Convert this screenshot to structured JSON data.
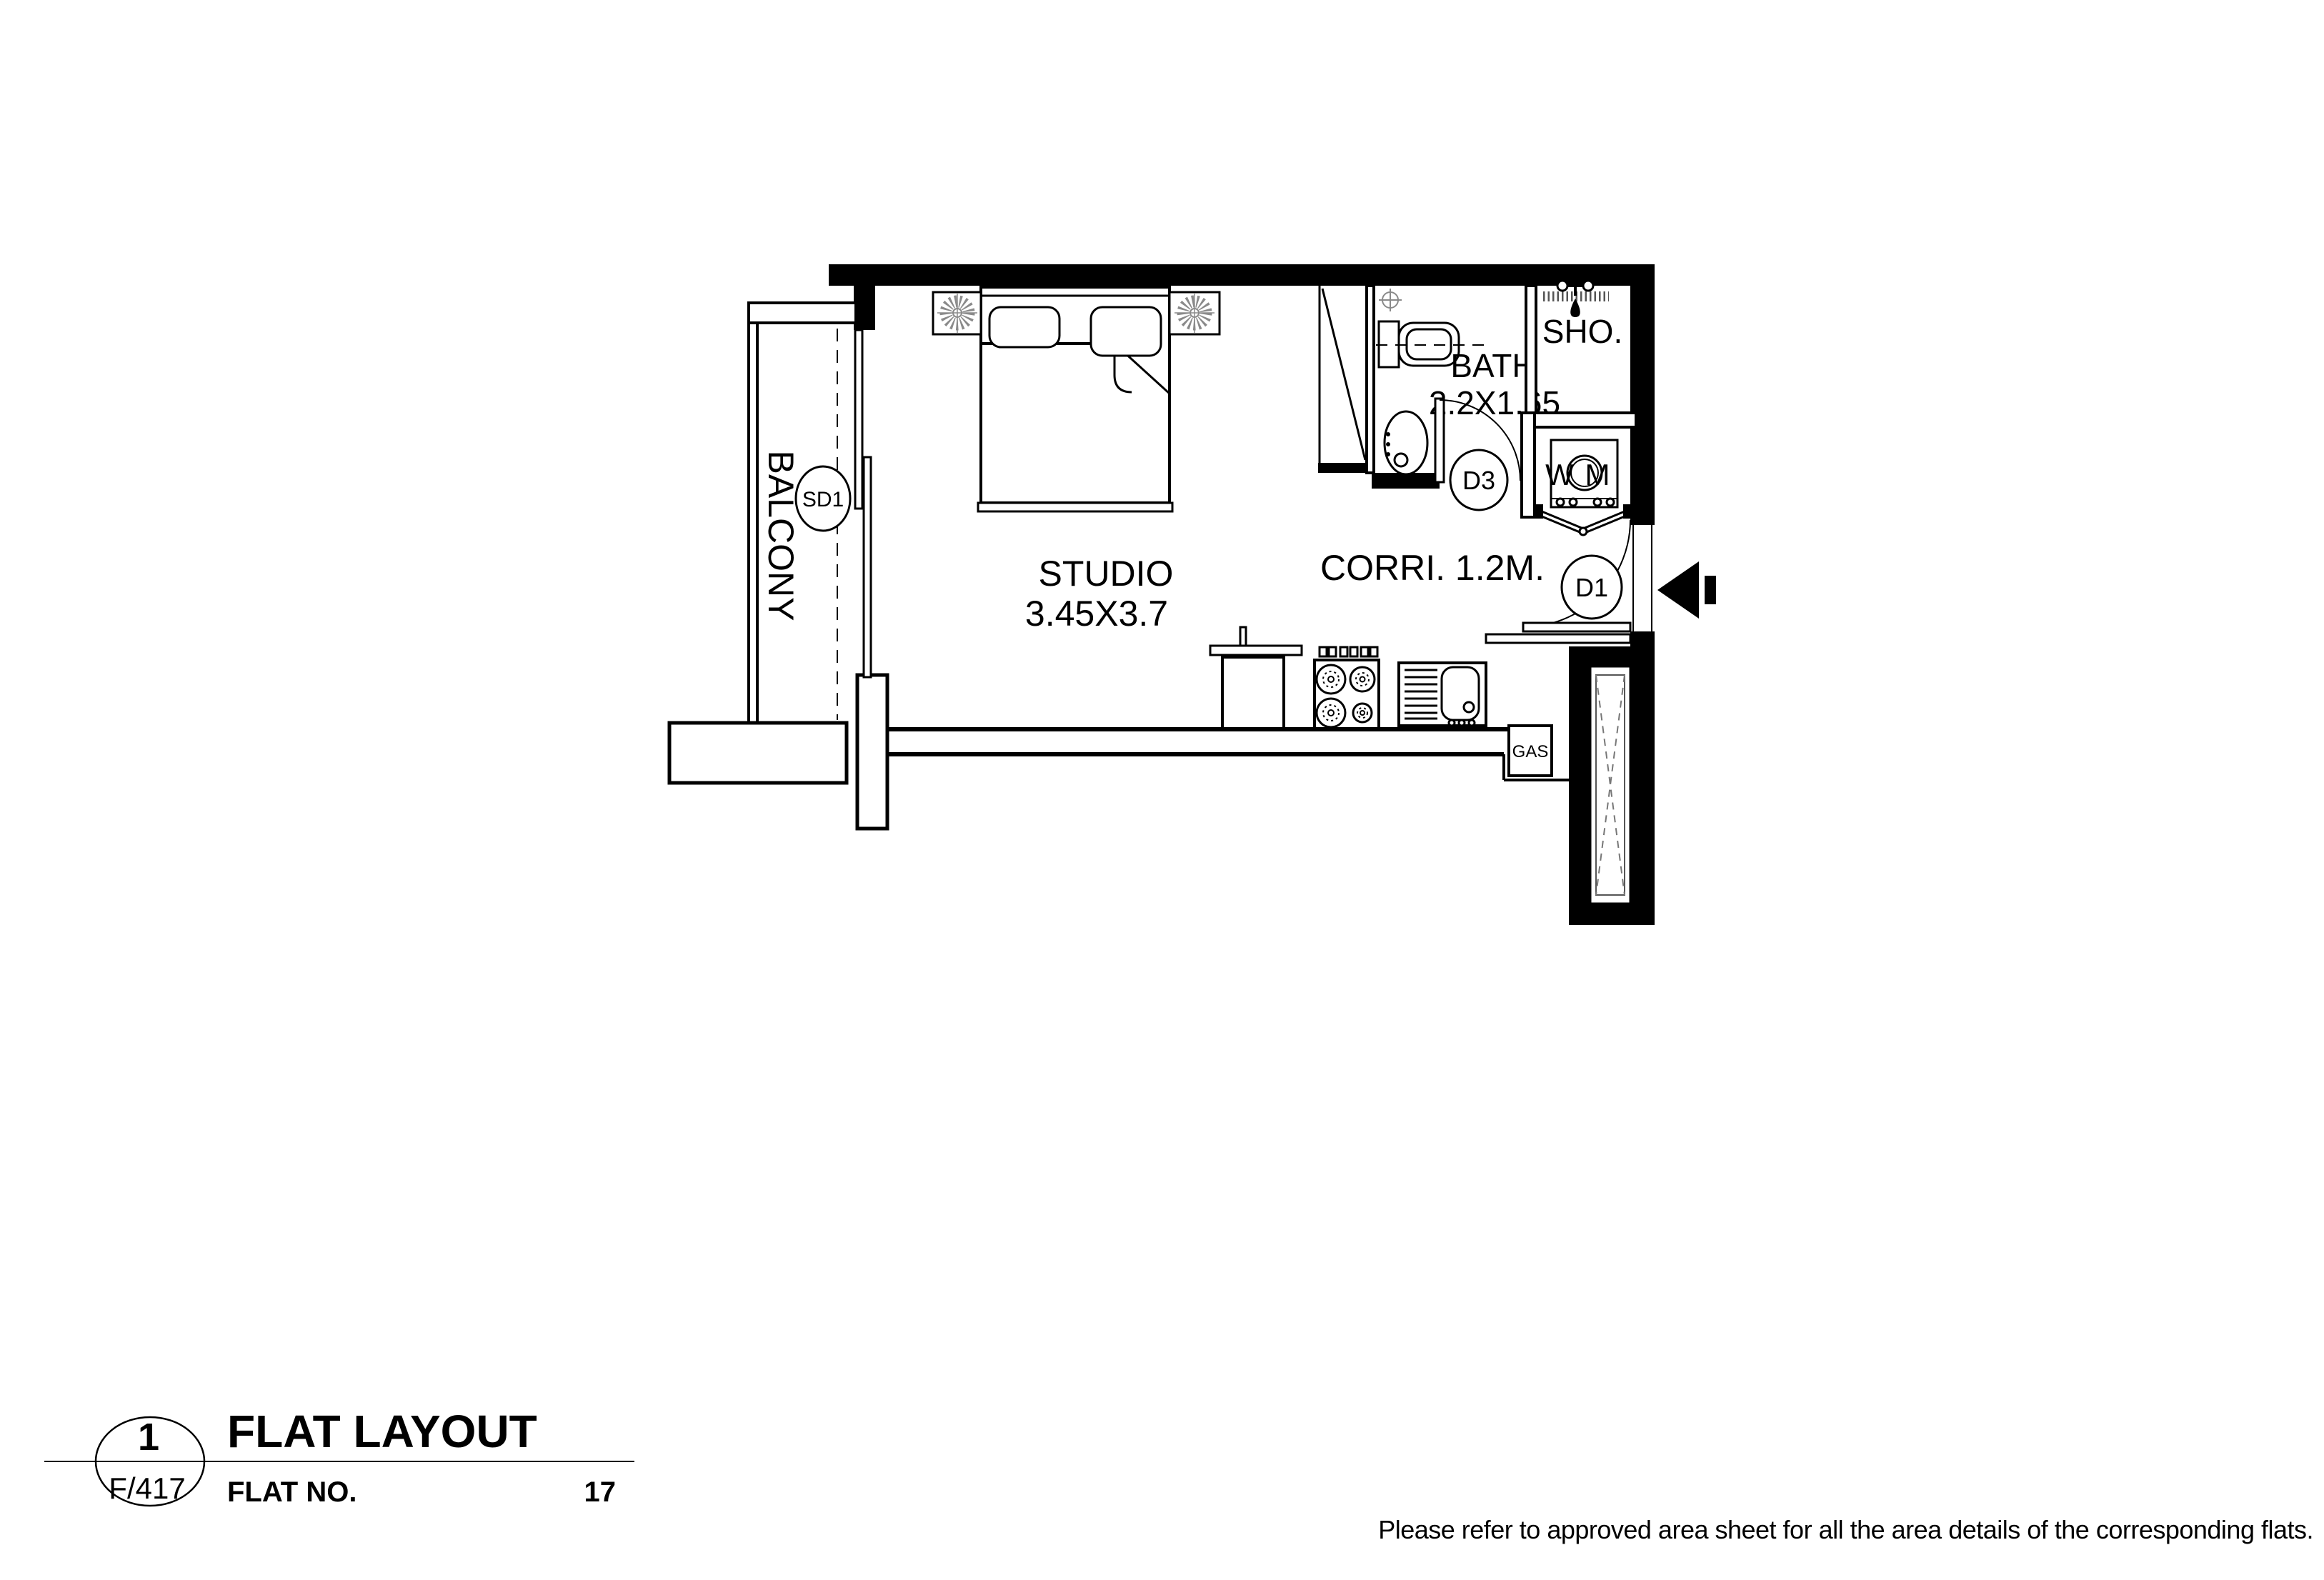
{
  "plan": {
    "balcony": {
      "label": "BALCONY",
      "door_tag": "SD1"
    },
    "studio": {
      "label": "STUDIO",
      "dimensions": "3.45X3.7"
    },
    "bath": {
      "label": "BATH",
      "dimensions": "2.2X1.65"
    },
    "shower": {
      "label": "SHO."
    },
    "corridor": {
      "label": "CORRI. 1.2M."
    },
    "doors": {
      "entrance_tag": "D1",
      "bath_tag": "D3"
    },
    "appliances": {
      "washing_machine_w": "W",
      "washing_machine_m": "M",
      "gas_box": "GAS"
    }
  },
  "title_block": {
    "detail_number": "1",
    "sheet_ref": "F/417",
    "title": "FLAT LAYOUT",
    "flat_no_label": "FLAT NO.",
    "flat_no_value": "17"
  },
  "footnote": "Please refer to approved area sheet for all the area details of the corresponding flats.",
  "colors": {
    "line": "#000000",
    "fixture_gray": "#8a8a8a",
    "paper": "#ffffff"
  }
}
